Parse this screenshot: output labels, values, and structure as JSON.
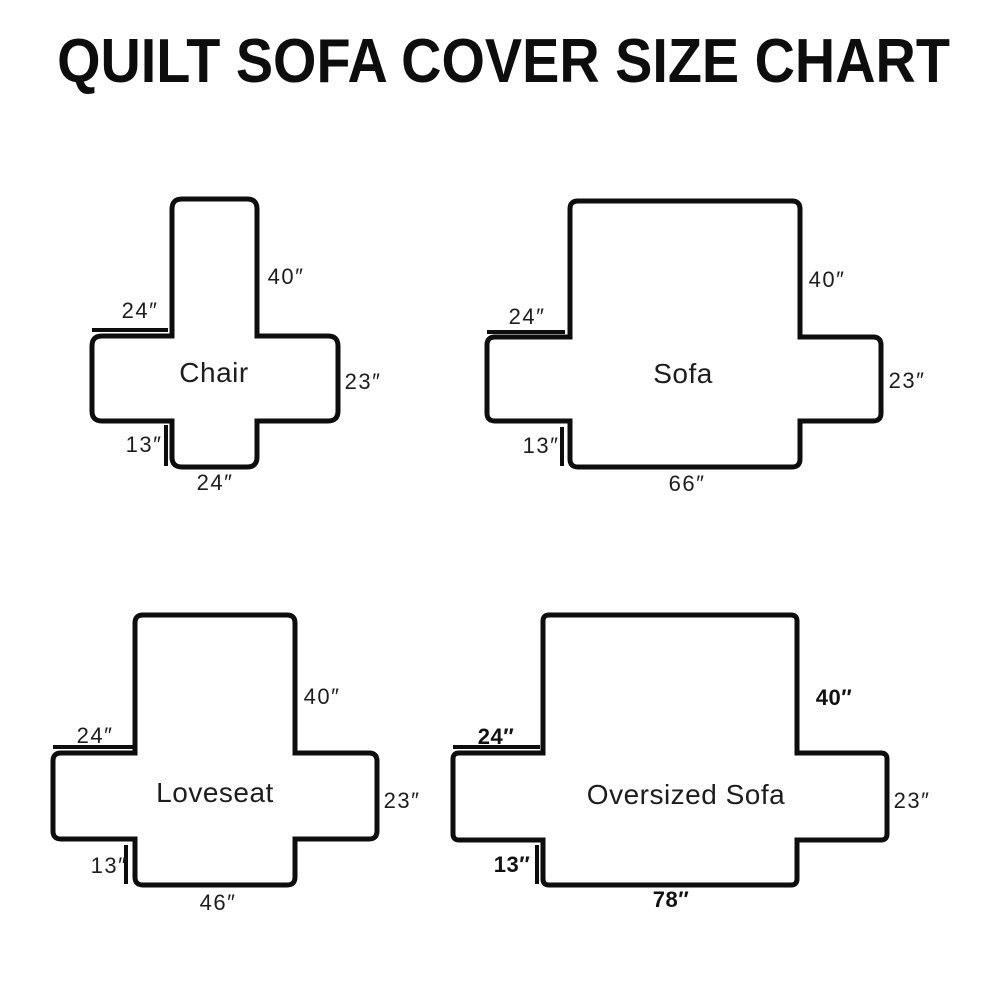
{
  "title": "QUILT SOFA COVER SIZE CHART",
  "colors": {
    "line": "#0d0d0d",
    "background": "#ffffff"
  },
  "diagrams": {
    "chair": {
      "name": "Chair",
      "back_height": "40″",
      "arm_top_width": "24″",
      "side_height": "23″",
      "skirt_height": "13″",
      "bottom_width": "24″"
    },
    "sofa": {
      "name": "Sofa",
      "back_height": "40″",
      "arm_top_width": "24″",
      "side_height": "23″",
      "skirt_height": "13″",
      "bottom_width": "66″"
    },
    "loveseat": {
      "name": "Loveseat",
      "back_height": "40″",
      "arm_top_width": "24″",
      "side_height": "23″",
      "skirt_height": "13″",
      "bottom_width": "46″"
    },
    "oversized_sofa": {
      "name": "Oversized Sofa",
      "back_height": "40″",
      "arm_top_width": "24″",
      "side_height": "23″",
      "skirt_height": "13″",
      "bottom_width": "78″"
    }
  }
}
